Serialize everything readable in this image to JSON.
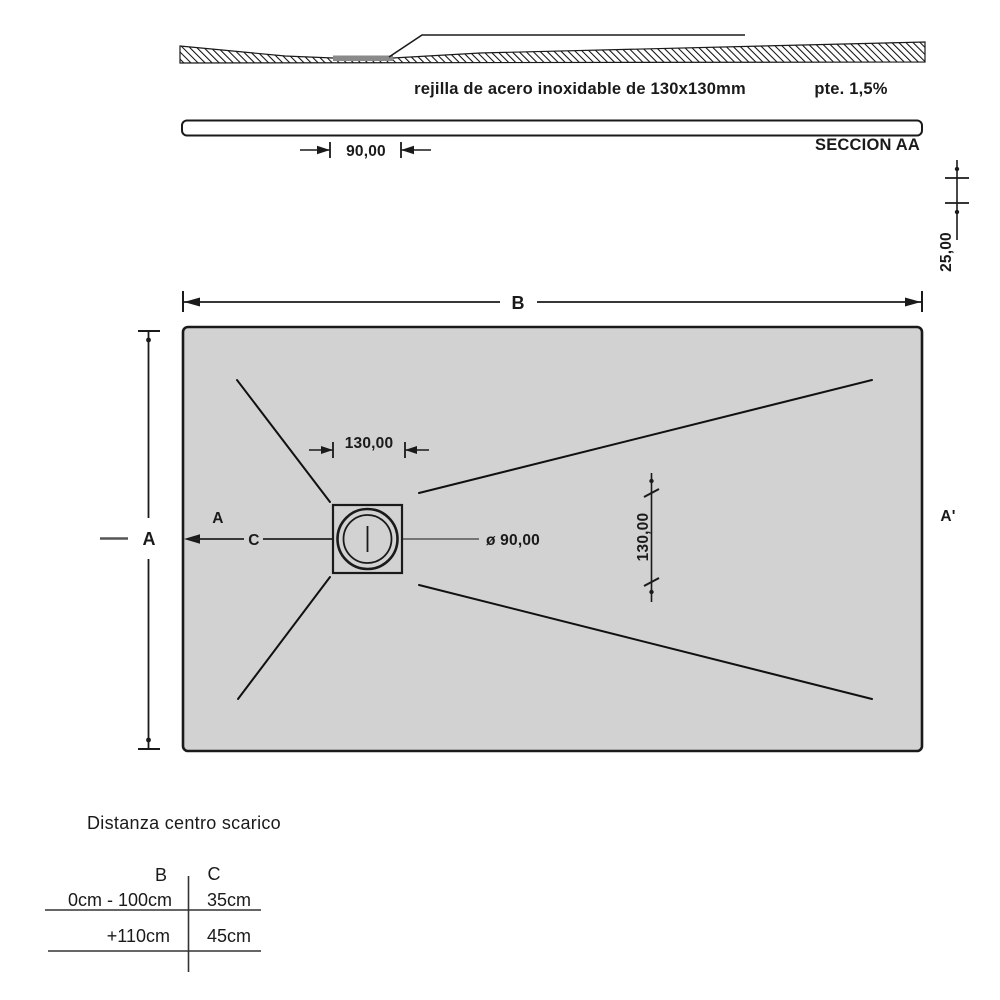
{
  "section_view": {
    "grate_note": "rejilla de acero inoxidable de 130x130mm",
    "slope_note": "pte. 1,5%",
    "drain_offset_dim": "90,00",
    "section_label": "SECCION AA",
    "thickness_dim": "25,00"
  },
  "plan_view": {
    "width_label": "B",
    "height_label": "A",
    "cut_start_label": "A",
    "cut_center_label": "C",
    "cut_end_label": "A'",
    "drain_width_dim": "130,00",
    "drain_height_dim": "130,00",
    "drain_diameter_dim": "ø 90,00"
  },
  "table": {
    "title": "Distanza centro scarico",
    "col1_header": "B",
    "col2_header": "C",
    "rows": [
      {
        "b": "0cm - 100cm",
        "c": "35cm"
      },
      {
        "b": "+110cm",
        "c": "45cm"
      }
    ]
  },
  "colors": {
    "tray_fill": "#d2d2d2",
    "line": "#1a1a1a",
    "grate_fill": "#8a8a8a",
    "centerline": "#666666"
  }
}
